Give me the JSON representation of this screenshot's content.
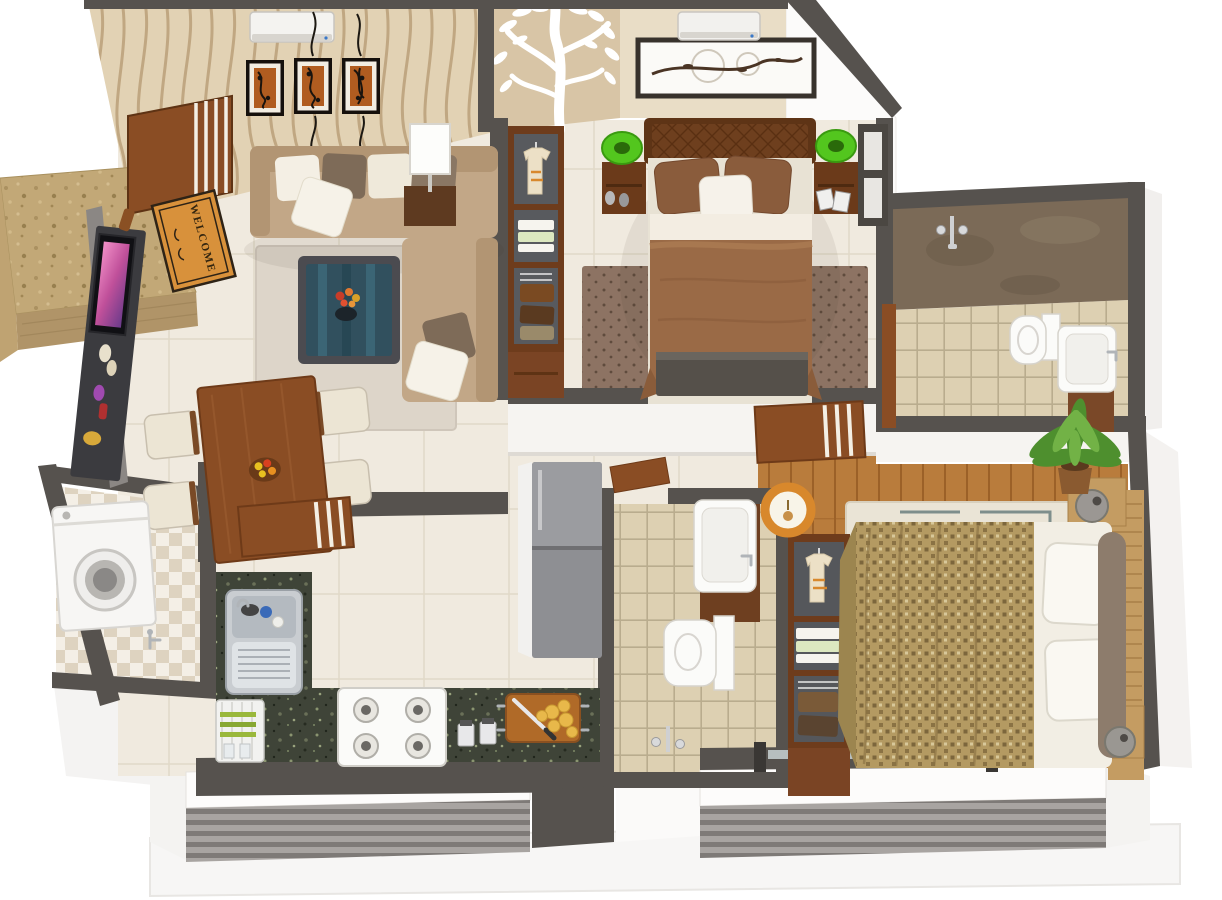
{
  "scene": {
    "kind": "3d-apartment-floor-plan-render",
    "view": "isometric-top-down",
    "background": "#ffffff"
  },
  "entrance": {
    "mat_text": "WELCOME",
    "furniture": [
      "porch-stone-step",
      "open-main-door",
      "welcome-mat"
    ]
  },
  "rooms": [
    {
      "id": "living-room",
      "furniture": [
        "wavy-wallpaper-wall",
        "three-wall-art-frames",
        "air-conditioner",
        "l-shaped-sofa",
        "throw-pillows",
        "glass-coffee-table-with-flowers",
        "area-rug",
        "tv-console",
        "flat-tv",
        "white-table-lamp",
        "side-table"
      ]
    },
    {
      "id": "dining-area",
      "furniture": [
        "wooden-dining-table",
        "four-chairs",
        "fruit-bowl",
        "open-striped-door"
      ]
    },
    {
      "id": "master-bedroom",
      "furniture": [
        "tree-decal-wall",
        "double-bed-brown-duvet",
        "tufted-headboard",
        "two-nightstands",
        "green-table-lamps",
        "branch-artwork-frame",
        "air-conditioner",
        "dotted-rug",
        "open-wardrobe-with-shirt",
        "foot-bench",
        "window-blinds",
        "open-striped-door"
      ]
    },
    {
      "id": "ensuite-bathroom",
      "furniture": [
        "marble-shower-wall",
        "shower-mixer",
        "beige-floor-tiles",
        "toilet",
        "vanity-sink",
        "door"
      ]
    },
    {
      "id": "common-bathroom",
      "furniture": [
        "beige-floor-tiles",
        "vanity-sink",
        "toilet",
        "shower-mixer",
        "open-door"
      ]
    },
    {
      "id": "kitchen",
      "furniture": [
        "l-shaped-granite-counter",
        "double-steel-sink",
        "dish-rack-with-plates",
        "four-burner-gas-hob",
        "spice-jars",
        "cutting-board-with-food-and-knife",
        "refrigerator"
      ]
    },
    {
      "id": "utility-room",
      "furniture": [
        "washing-machine",
        "checkered-tile-floor",
        "water-tap"
      ]
    },
    {
      "id": "second-bedroom",
      "furniture": [
        "wooden-plank-floor",
        "double-bed-patterned-duvet",
        "white-pillows",
        "taupe-bolster",
        "slatted-headboard-bench",
        "geometric-rug",
        "open-wardrobe-with-shirt",
        "ring-pendant-lamp",
        "drum-lamp",
        "ball-lamp",
        "palm-plant"
      ]
    },
    {
      "id": "balconies",
      "furniture": [
        "louvered-railing-left",
        "louvered-railing-right",
        "white-parapet",
        "building-base"
      ]
    }
  ],
  "palette": {
    "wall": "#56524e",
    "wallDark": "#3a3734",
    "wallFace": "#f6f4f1",
    "wallpaper": "#e2d2b4",
    "wallpaperLine": "#b3946c",
    "treeWall": "#d8c5a6",
    "bedroomWall": "#e9ddc6",
    "floorCream": "#f0eadf",
    "floorLine": "#e1d9c8",
    "tileBeige": "#ddd0b2",
    "tileGrout": "#b9ac8e",
    "checkerLight": "#f4efe6",
    "checkerDark": "#ded3c0",
    "woodFloor": "#b97c3c",
    "woodLine": "#9c6128",
    "furnitureWood": "#8a4d24",
    "darkWood": "#6e3c1c",
    "sofa": "#c2a787",
    "sofaBack": "#b29573",
    "cushionBrown": "#7e6b58",
    "cushionCream": "#f2ecdf",
    "rugLiving": "#ddd5c9",
    "rugBedroom": "#8d7363",
    "rugDot": "#5f4b3d",
    "rug2": "#eae4d6",
    "duvet": "#9a6a46",
    "pillowBrown": "#8a5c3c",
    "headboard": "#5e3416",
    "bed2": "#b49a62",
    "bed2Dot": "#7c663c",
    "granite": "#3f4438",
    "steel": "#c9cdd1",
    "whiteFix": "#fbfbf9",
    "tvDark": "#3b3b3f",
    "lampGreen": "#53c61e",
    "mat": "#d8913b",
    "matText": "#33250f",
    "marble": "#7b6a57",
    "stone": "#c2a877",
    "slatA": "#a8a4a1",
    "slatB": "#7e7a77",
    "plant": "#4e8f2e",
    "plantLight": "#72b246",
    "accent": "#d8882c",
    "glass": "#31505e",
    "base": "#f7f6f5"
  }
}
